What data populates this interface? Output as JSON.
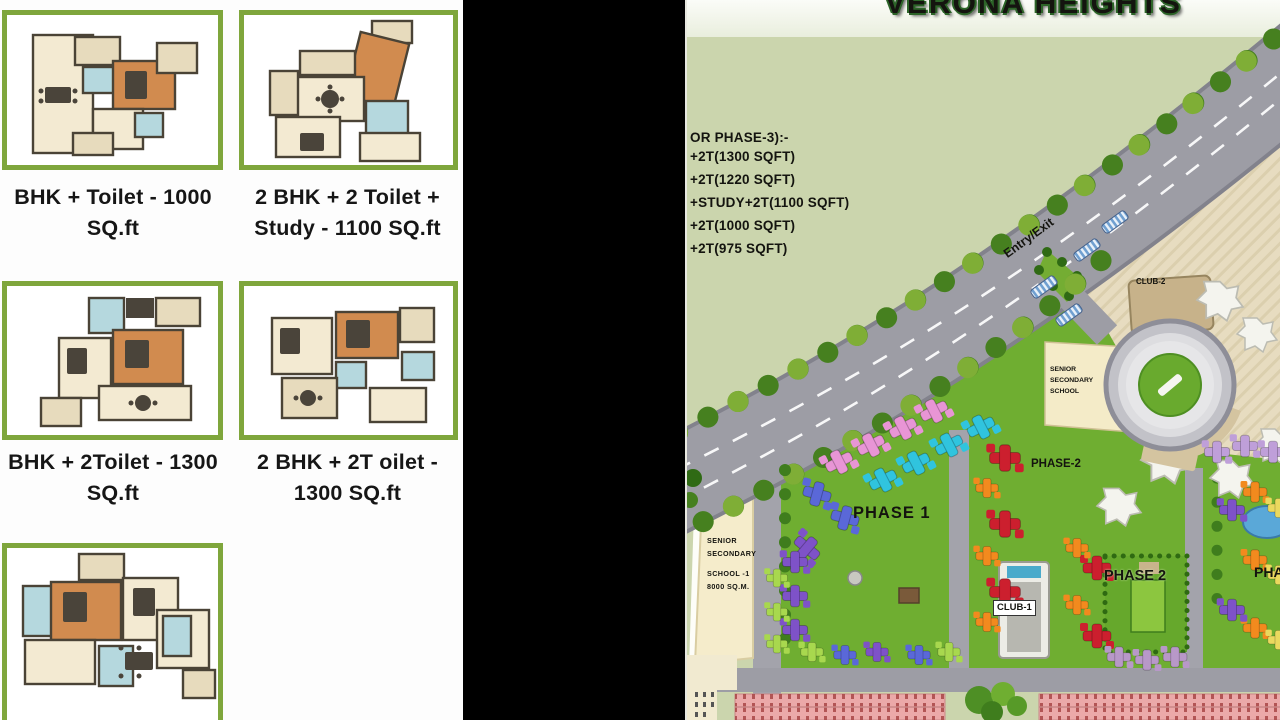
{
  "colors": {
    "frame_green": "#7fa63c",
    "divider_black": "#000000",
    "sage_background": "#cbd5ad",
    "road_gray": "#9d9da5",
    "lawn_green": "#6fae31",
    "plaza_tan": "#e7dcc0",
    "parking_pink": "#eba9a9",
    "title_outline_green": "#2c6428"
  },
  "floor_plans": {
    "cards": [
      {
        "caption": [
          "BHK + Toilet - 1000",
          "SQ.ft"
        ]
      },
      {
        "caption": [
          "2 BHK + 2 Toilet +",
          "Study - 1100 SQ.ft"
        ]
      },
      {
        "caption": [
          "BHK + 2Toilet - 1300",
          "SQ.ft"
        ]
      },
      {
        "caption": [
          "2 BHK + 2T oilet -",
          "1300 SQ.ft"
        ]
      },
      {
        "caption": [
          "",
          ""
        ]
      }
    ]
  },
  "site_plan": {
    "title": "VERONA HEIGHTS",
    "unit_list_heading": "OR PHASE-3):-",
    "unit_list": [
      "+2T(1300 SQFT)",
      "+2T(1220 SQFT)",
      "+STUDY+2T(1100 SQFT)",
      "+2T(1000 SQFT)",
      "+2T(975 SQFT)"
    ],
    "labels": {
      "entry_exit": "Entry/Exit",
      "club_2": "CLUB-2",
      "school_upper_l1": "SENIOR",
      "school_upper_l2": "SECONDARY",
      "school_upper_l3": "SCHOOL",
      "phase_2_upper": "PHASE-2",
      "phase_1": "PHASE 1",
      "school_left_l1": "SENIOR",
      "school_left_l2": "SECONDARY",
      "school_left_l3": "SCHOOL -1",
      "school_left_l4": "8000 SQ.M.",
      "club_1": "CLUB-1",
      "phase_2_lower": "PHASE 2",
      "phase_3_partial": "PHA"
    }
  }
}
